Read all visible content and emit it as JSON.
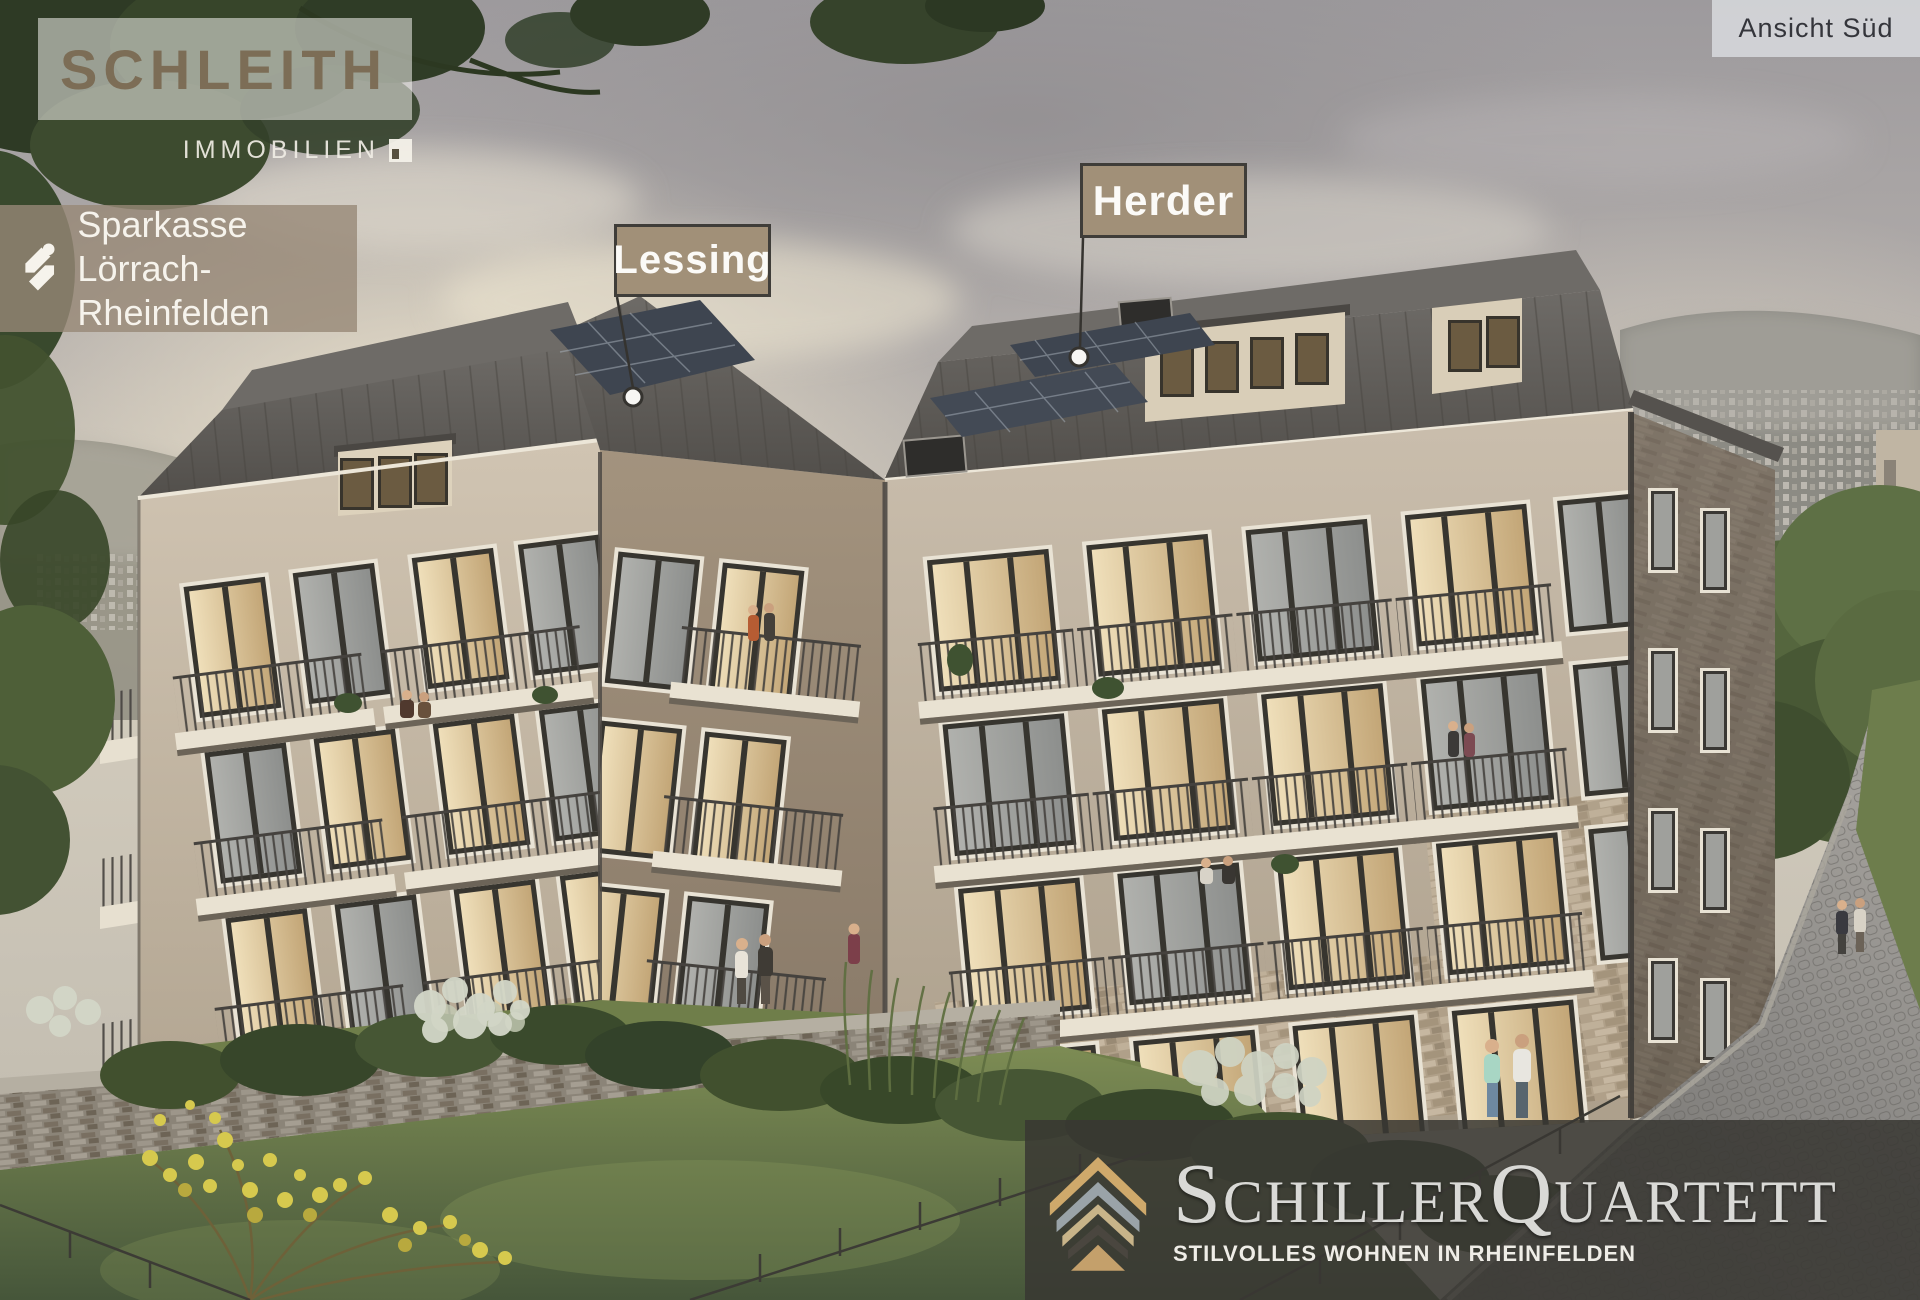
{
  "view_label": {
    "text": "Ansicht Süd"
  },
  "schleith_logo": {
    "name": "SCHLEITH",
    "subtitle": "IMMOBILIEN"
  },
  "sparkasse_logo": {
    "line1": "Sparkasse",
    "line2": "Lörrach-Rheinfelden"
  },
  "building_labels": [
    {
      "label": "Lessing"
    },
    {
      "label": "Herder"
    }
  ],
  "project": {
    "title_part1": "Schiller",
    "title_part2": "Quartett",
    "subtitle": "STILVOLLES WOHNEN IN RHEINFELDEN"
  },
  "icons": {
    "sparkasse_mark": "sparkasse-s-icon",
    "schleith_mark": "schleith-cube-icon",
    "project_mark": "roof-layers-icon"
  },
  "colors": {
    "label_bg": "#a19078",
    "label_border": "#3f3d39",
    "label_text": "#fbfaf7",
    "footer_bg": "rgba(56,55,50,0.85)",
    "footer_title": "#d9d9d6",
    "sparkasse_bg": "rgba(151,136,119,0.8)",
    "schleith_text": "#7a6850",
    "roof_gray": "#5b5855",
    "facade_beige": "#c6baa8",
    "solar_blue": "#3e4550",
    "gold": "#c9a96e"
  }
}
